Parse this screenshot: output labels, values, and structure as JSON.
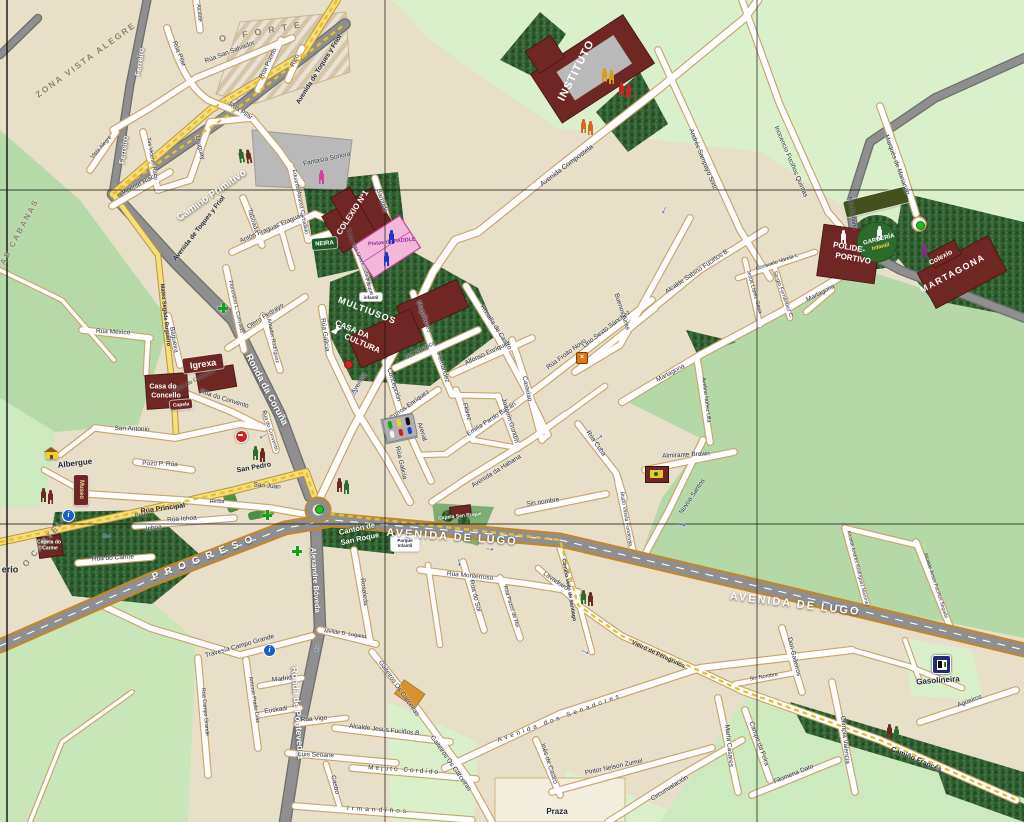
{
  "map": {
    "town": "Melide street map",
    "colors": {
      "background_tan": "#e8dfc9",
      "field_green": "#b6daa7",
      "field_mint": "#d9f0ca",
      "forest_green": "#2f5c2f",
      "road_gray": "#8f8f8f",
      "road_casing_gold": "#c1872b",
      "street_white": "#ffffff",
      "street_casing": "#c9a468",
      "yellow_road": "#f4df7a",
      "camino_dash": "#e8bf2e",
      "building_maroon": "#6f2723",
      "courts_pink": "#f3b8d9",
      "plaza_gray": "#b9b9b9",
      "sign_green": "#1e5b28"
    },
    "labels": [
      [
        "ZONA VISTA ALEGRE",
        86,
        60,
        -36,
        "ar",
        8.5,
        2
      ],
      [
        "O FORTE",
        263,
        32,
        -10,
        "ar",
        9,
        7
      ],
      [
        "AS CABANAS",
        20,
        232,
        -62,
        "ar",
        8,
        2
      ],
      [
        "O CASTELO",
        46,
        540,
        -50,
        "ar",
        8.5,
        2
      ],
      [
        "PROGRESO",
        206,
        558,
        -21,
        "arw",
        10,
        7
      ],
      [
        "Camiño Primitivo",
        212,
        196,
        -35,
        "rw",
        10
      ],
      [
        "Ferreiro",
        140,
        62,
        -82,
        "rws"
      ],
      [
        "Ferreiro",
        124,
        150,
        -82,
        "rws"
      ],
      [
        "Ronda da Coruña",
        266,
        390,
        62,
        "rw",
        9.5
      ],
      [
        "Ronda de Pontevedra",
        297,
        713,
        86,
        "rw",
        9
      ],
      [
        "Alexandre Bóveda",
        315,
        580,
        86,
        "rws"
      ],
      [
        "AVENIDA DE LUGO",
        452,
        538,
        4,
        "rwl"
      ],
      [
        "AVENIDA DE LUGO",
        795,
        605,
        7,
        "rwl"
      ],
      [
        "Avenida de Toques y Friol",
        320,
        70,
        -58,
        "yl"
      ],
      [
        "Avenida de Toques y Friol",
        200,
        229,
        -52,
        "yl"
      ],
      [
        "Mateo Segade Bugueiro",
        164,
        315,
        84,
        "yl",
        5.5
      ],
      [
        "Rúa Principal",
        163,
        509,
        -8,
        "yl",
        7
      ],
      [
        "San Pedro",
        254,
        468,
        -10,
        "yl",
        7
      ],
      [
        "San Juan",
        267,
        487,
        5,
        "st"
      ],
      [
        "Camiño Francés",
        916,
        760,
        23,
        "yl",
        7
      ],
      [
        "Vieiro de Peregrinos",
        658,
        655,
        25,
        "yl",
        6
      ],
      [
        "Camiño Vello de Santiago",
        568,
        590,
        80,
        "yls"
      ],
      [
        "Rúa Pilar",
        178,
        54,
        68,
        "st"
      ],
      [
        "Rúa Pilar",
        240,
        112,
        32,
        "st"
      ],
      [
        "Rúa San Salvador",
        230,
        53,
        -21,
        "st"
      ],
      [
        "Rúa Puerto",
        269,
        64,
        -64,
        "st"
      ],
      [
        "Rico",
        296,
        61,
        -64,
        "st"
      ],
      [
        "Alcalde",
        198,
        13,
        84,
        "sts"
      ],
      [
        "Tvs Vicente Risco",
        151,
        159,
        80,
        "sts"
      ],
      [
        "Vicente Risco",
        140,
        185,
        -27,
        "st"
      ],
      [
        "Vista Alegre",
        102,
        148,
        -48,
        "sts"
      ],
      [
        "Uruguay",
        199,
        148,
        76,
        "st"
      ],
      [
        "Rúa México",
        113,
        333,
        3,
        "st"
      ],
      [
        "Bagueira",
        173,
        340,
        80,
        "st"
      ],
      [
        "Praza do Convento",
        194,
        382,
        -27,
        "sts"
      ],
      [
        "Rúa do Convento",
        224,
        400,
        17,
        "st"
      ],
      [
        "Rúa do Convento",
        269,
        431,
        72,
        "sts"
      ],
      [
        "San Antonio",
        132,
        430,
        2,
        "st"
      ],
      [
        "Pozo P. Rúa",
        160,
        465,
        2,
        "st"
      ],
      [
        "Rúa Ichoa",
        182,
        520,
        -4,
        "st"
      ],
      [
        "Ichoa",
        154,
        529,
        -8,
        "st"
      ],
      [
        "Praza",
        142,
        516,
        -4,
        "sts"
      ],
      [
        "Herba",
        217,
        503,
        0,
        "sts"
      ],
      [
        "Rúa do Carme",
        113,
        559,
        -3,
        "st"
      ],
      [
        "erio",
        10,
        570,
        0,
        "dk",
        9
      ],
      [
        "Eduardo Álvarez Carballido",
        299,
        202,
        79,
        "sts"
      ],
      [
        "Taboada",
        252,
        221,
        72,
        "st"
      ],
      [
        "Antón Fraguas Fraguas",
        272,
        229,
        -23,
        "st"
      ],
      [
        "Florentino L. Cuevillas",
        235,
        307,
        77,
        "sts"
      ],
      [
        "Otero Pedrayo",
        266,
        317,
        -33,
        "st"
      ],
      [
        "Amador Rodríguez",
        272,
        341,
        79,
        "sts"
      ],
      [
        "Praza das Universidades",
        358,
        257,
        68,
        "sts"
      ],
      [
        "Fantasía Sonora",
        327,
        160,
        -12,
        "st"
      ],
      [
        "Barbudo",
        381,
        201,
        72,
        "st"
      ],
      [
        "Magallanes",
        423,
        317,
        70,
        "st"
      ],
      [
        "de América",
        421,
        351,
        -27,
        "st"
      ],
      [
        "Fernández",
        442,
        368,
        73,
        "st"
      ],
      [
        "Flórez",
        466,
        412,
        73,
        "st"
      ],
      [
        "Concepción",
        393,
        385,
        73,
        "st"
      ],
      [
        "Arenal",
        421,
        432,
        73,
        "st"
      ],
      [
        "Curros Enríquez",
        410,
        406,
        -36,
        "st"
      ],
      [
        "Alfonso Enríquez",
        488,
        354,
        -25,
        "st"
      ],
      [
        "Rosalía de Castro",
        495,
        328,
        57,
        "st"
      ],
      [
        "Castelao",
        526,
        389,
        77,
        "st"
      ],
      [
        "Emilia Pardo Bazán",
        492,
        420,
        -33,
        "st"
      ],
      [
        "Rúa Froito Novo",
        567,
        355,
        -36,
        "st"
      ],
      [
        "Lino Sexto Sánchez",
        607,
        330,
        -37,
        "st"
      ],
      [
        "Joaquín Gundín",
        509,
        421,
        73,
        "st"
      ],
      [
        "Avenida da Habana",
        497,
        472,
        -32,
        "st"
      ],
      [
        "Rúa Galicia",
        324,
        335,
        82,
        "st"
      ],
      [
        "Rúa Galicia",
        400,
        463,
        77,
        "st"
      ],
      [
        "Avenida",
        360,
        384,
        -57,
        "st"
      ],
      [
        "Buenos Aires",
        621,
        312,
        72,
        "st"
      ],
      [
        "Alcalde Sabino Fuciños B.",
        698,
        272,
        -34,
        "st"
      ],
      [
        "Jesús López Gaua",
        753,
        292,
        74,
        "sts"
      ],
      [
        "Consuelo Varela L.",
        778,
        263,
        -18,
        "sts"
      ],
      [
        "Sergio Fernández C.",
        782,
        295,
        70,
        "sts"
      ],
      [
        "Andrés Sampayo Sixto",
        702,
        160,
        68,
        "st"
      ],
      [
        "Inocencio Fuciños Quintas",
        790,
        162,
        67,
        "st"
      ],
      [
        "Avenida Compostela",
        567,
        166,
        -37,
        "st",
        7
      ],
      [
        "Marqués de Marianao",
        896,
        165,
        70,
        "st"
      ],
      [
        "Rúa Bolmorto",
        851,
        213,
        81,
        "sts"
      ],
      [
        "Martagona",
        671,
        374,
        -28,
        "st"
      ],
      [
        "Martagona",
        821,
        294,
        -28,
        "st"
      ],
      [
        "Avelino Núñez Ulla",
        705,
        400,
        83,
        "sts"
      ],
      [
        "Almirante Brown",
        686,
        456,
        -3,
        "st"
      ],
      [
        "Rúa Cuba",
        595,
        444,
        55,
        "st"
      ],
      [
        "Bispo Varela Fondevila",
        625,
        519,
        81,
        "sts"
      ],
      [
        "Novoa Santos",
        693,
        497,
        -56,
        "st"
      ],
      [
        "Sin nombre",
        543,
        503,
        -8,
        "st"
      ],
      [
        "Sin Nombre",
        764,
        678,
        -10,
        "sts"
      ],
      [
        "Rúa Monterroso",
        470,
        577,
        6,
        "st"
      ],
      [
        "Rúa do Sol",
        474,
        596,
        76,
        "st"
      ],
      [
        "Rúa Pazos de Rei",
        510,
        607,
        73,
        "sts"
      ],
      [
        "Lavadoiro",
        555,
        582,
        34,
        "st"
      ],
      [
        "Alcalde Andrés Rodríguez Martínez",
        857,
        569,
        76,
        "sts",
        5
      ],
      [
        "Alcalde Jesús Fuciños Segade",
        935,
        586,
        72,
        "sts",
        5
      ],
      [
        "Don Gaiteiros",
        793,
        657,
        76,
        "st"
      ],
      [
        "Olimpia Valencia",
        844,
        740,
        84,
        "st"
      ],
      [
        "Agüeiros",
        970,
        702,
        -20,
        "st"
      ],
      [
        "Filomena Dato",
        794,
        775,
        -22,
        "st"
      ],
      [
        "Campo da Feira",
        758,
        744,
        70,
        "st"
      ],
      [
        "María Casares",
        728,
        746,
        84,
        "st"
      ],
      [
        "Circunvalación",
        670,
        789,
        -32,
        "st"
      ],
      [
        "Pintor Nelson Zumel",
        614,
        768,
        -12,
        "st"
      ],
      [
        "Inés de Castro",
        548,
        764,
        72,
        "st"
      ],
      [
        "Avenida dos Senadores",
        560,
        719,
        -20,
        "st",
        6.5,
        3
      ],
      [
        "Praza",
        557,
        812,
        0,
        "dk"
      ],
      [
        "Irmandiños",
        378,
        811,
        3,
        "st",
        6.5,
        3
      ],
      [
        "Mejuto Cordido",
        404,
        771,
        4,
        "st",
        6.5,
        2
      ],
      [
        "Luis Seoane",
        316,
        756,
        2,
        "st"
      ],
      [
        "Castro",
        334,
        785,
        77,
        "st"
      ],
      [
        "Gaiteiros Os Garceiras",
        398,
        689,
        55,
        "st"
      ],
      [
        "Gaiteiros Os Garceiras",
        450,
        764,
        55,
        "st"
      ],
      [
        "Alcalde Jesús Fuciños B.",
        385,
        731,
        6,
        "st"
      ],
      [
        "Rúa Vigo",
        314,
        720,
        -4,
        "st"
      ],
      [
        "Euskadi",
        276,
        711,
        -8,
        "st"
      ],
      [
        "Madrid",
        282,
        680,
        -6,
        "st"
      ],
      [
        "Antonio Prado Díaz",
        253,
        700,
        81,
        "sts"
      ],
      [
        "Rúa Campo Grande",
        204,
        712,
        85,
        "sts"
      ],
      [
        "Travesía Campo Grande",
        240,
        647,
        -16,
        "st"
      ],
      [
        "Melide D. Lugano",
        345,
        635,
        8,
        "sts"
      ],
      [
        "Rosaleda",
        363,
        592,
        83,
        "st"
      ],
      [
        "Parque",
        368,
        287,
        72,
        "sts"
      ],
      [
        "Pistas de PADDLE",
        392,
        243,
        -6,
        "pad"
      ],
      [
        "Cantón de",
        357,
        529,
        -12,
        "pk"
      ],
      [
        "San Roque",
        360,
        539,
        -12,
        "pk"
      ],
      [
        "Capela San Roque",
        460,
        517,
        -6,
        "pks"
      ],
      [
        "Capela do",
        49,
        543,
        0,
        "pks"
      ],
      [
        "Carme",
        50,
        549,
        0,
        "pks"
      ],
      [
        "Casa do",
        163,
        387,
        0,
        "poi",
        7
      ],
      [
        "Concello",
        166,
        396,
        0,
        "poi",
        7
      ],
      [
        "Albergue",
        75,
        464,
        -7,
        "dk",
        8
      ],
      [
        "Gasolineira",
        938,
        681,
        -4,
        "dk",
        8
      ],
      [
        "INSTITUTO",
        577,
        71,
        -63,
        "poi",
        11,
        1
      ],
      [
        "COLEXIO Nº1",
        353,
        213,
        -57,
        "poi",
        8
      ],
      [
        "MULTIUSOS",
        367,
        311,
        21,
        "poi",
        9,
        1
      ],
      [
        "CASA DA",
        352,
        330,
        23,
        "poi",
        8
      ],
      [
        "CULTURA",
        362,
        344,
        23,
        "poi",
        8
      ],
      [
        "POLIDE-",
        849,
        248,
        10,
        "poi",
        8
      ],
      [
        "PORTIVO",
        853,
        259,
        10,
        "poi",
        8
      ],
      [
        "GARDERÍA",
        879,
        240,
        -14,
        "poi",
        6
      ],
      [
        "Infantil",
        881,
        248,
        -14,
        "poiy",
        5.5
      ],
      [
        "Colexio",
        941,
        258,
        -28,
        "poi",
        7
      ],
      [
        "MARTAGONA",
        953,
        274,
        -28,
        "poi",
        9,
        1.5
      ]
    ],
    "signs": [
      [
        "Igrexa",
        203,
        363,
        40,
        15,
        -8,
        "#6f2723",
        "#ffffff",
        9
      ],
      [
        "NEIRA",
        324,
        243,
        25,
        11,
        -5,
        "#1e5b28",
        "#ffffff",
        6
      ],
      [
        "Museo",
        81,
        490,
        14,
        30,
        0,
        "#6f2723",
        "#f0d9a0",
        6,
        1
      ],
      [
        "Capela",
        181,
        404,
        22,
        9,
        -5,
        "#6f2723",
        "#ffffff",
        5
      ],
      [
        "",
        876,
        202,
        64,
        16,
        -14,
        "#44511d",
        "#ffffff",
        6
      ],
      [
        "Parque Infantil",
        405,
        543,
        28,
        15,
        0,
        "#ffffff",
        "#1c2433",
        4.5
      ],
      [
        "infantil",
        371,
        297,
        22,
        8,
        0,
        "#ffffff",
        "#1c2433",
        4.5
      ]
    ],
    "icons": [
      [
        "pilgrims",
        238,
        148,
        -10,
        "#2e6b2a",
        "#6b2a1f"
      ],
      [
        "pilgrims",
        40,
        488,
        0,
        "#6b2a1f",
        "#6b2a1f"
      ],
      [
        "pilgrims",
        336,
        478,
        0,
        "#6b2a1f",
        "#2e6b2a"
      ],
      [
        "pilgrims",
        252,
        446,
        0,
        "#2e6b2a",
        "#6b2a1f"
      ],
      [
        "pilgrims",
        580,
        590,
        0,
        "#2e6b2a",
        "#6b2a1f"
      ],
      [
        "pilgrims",
        886,
        724,
        0,
        "#6b2a1f",
        "#2e6b2a"
      ],
      [
        "pilgrims",
        601,
        68,
        0,
        "#d4a017",
        "#d4a017"
      ],
      [
        "pilgrims",
        618,
        82,
        0,
        "#cc2222",
        "#cc2222"
      ],
      [
        "pilgrims",
        580,
        119,
        0,
        "#d2691e",
        "#d2691e"
      ],
      [
        "person",
        318,
        170,
        0,
        "#d63fa0",
        ""
      ],
      [
        "person",
        921,
        243,
        0,
        "#8a2a8a",
        ""
      ],
      [
        "person",
        840,
        230,
        0,
        "#f5f5f5",
        ""
      ],
      [
        "person",
        876,
        226,
        0,
        "#f5f5f5",
        ""
      ],
      [
        "person",
        388,
        230,
        0,
        "#2233cc",
        ""
      ],
      [
        "person",
        383,
        252,
        0,
        "#2233cc",
        ""
      ],
      [
        "cross",
        218,
        303,
        0,
        "",
        ""
      ],
      [
        "cross",
        262,
        500,
        0,
        "",
        ""
      ],
      [
        "cross",
        292,
        526,
        0,
        "",
        ""
      ],
      [
        "info",
        62,
        509,
        0,
        "",
        ""
      ],
      [
        "info",
        263,
        644,
        0,
        "",
        ""
      ],
      [
        "noentry",
        235,
        400,
        0,
        "",
        ""
      ],
      [
        "dot",
        344,
        360,
        0,
        "#e01b1b",
        ""
      ],
      [
        "dot",
        315,
        505,
        0,
        "#18c418",
        ""
      ],
      [
        "dot",
        916,
        221,
        0,
        "#18c418",
        ""
      ],
      [
        "gas",
        932,
        655,
        0,
        "",
        ""
      ],
      [
        "house",
        44,
        447,
        0,
        "",
        ""
      ],
      [
        "flag",
        645,
        466,
        0,
        "",
        ""
      ],
      [
        "orange",
        576,
        352,
        0,
        "",
        ""
      ],
      [
        "parking",
        384,
        416,
        0,
        "",
        ""
      ],
      [
        "dove",
        330,
        324,
        -15,
        "",
        ""
      ],
      [
        "arrow",
        258,
        432,
        150,
        "",
        ""
      ],
      [
        "arrow",
        348,
        386,
        -60,
        "",
        ""
      ],
      [
        "arrow",
        400,
        526,
        8,
        "",
        ""
      ],
      [
        "arrow",
        484,
        541,
        5,
        "",
        ""
      ],
      [
        "arrow",
        592,
        430,
        -35,
        "",
        ""
      ],
      [
        "arrow",
        676,
        517,
        10,
        "",
        ""
      ],
      [
        "arrow",
        313,
        642,
        100,
        "",
        ""
      ],
      [
        "arrow",
        101,
        532,
        180,
        "",
        ""
      ],
      [
        "arrow",
        455,
        556,
        80,
        "",
        ""
      ],
      [
        "arrow",
        580,
        644,
        25,
        "",
        ""
      ],
      [
        "arrow",
        660,
        205,
        115,
        "",
        ""
      ]
    ]
  }
}
